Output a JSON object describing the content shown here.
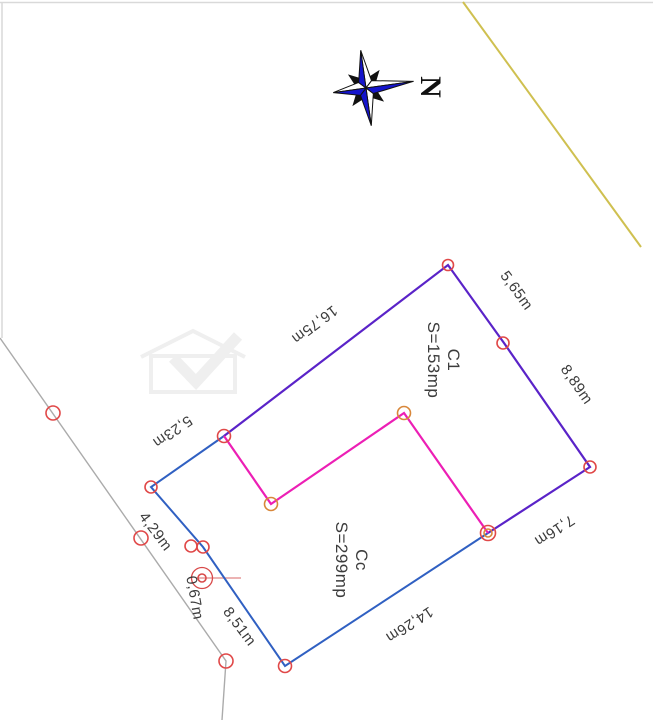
{
  "compass": {
    "north_label": "N"
  },
  "colors": {
    "boundary_blue": "#3060c2",
    "building_purple": "#5a23c8",
    "inner_pink": "#ec1fb5",
    "vertex_red": "#e04848",
    "vertex_orange": "#d8873a",
    "road_gray": "#ababab",
    "utility_yellow": "#cfc050",
    "target_red": "#d84848",
    "leader_pink": "#e59a9a",
    "label_color": "#3c3c3c",
    "compass_blue": "#1414cc",
    "compass_black": "#111111",
    "watermark_gray": "#efefef",
    "frame_gray": "#d9d9d9"
  },
  "dimensions": [
    {
      "id": "edge-ga",
      "text": "16,75m"
    },
    {
      "id": "edge-ab",
      "text": "5,65m"
    },
    {
      "id": "edge-bc",
      "text": "8,89m"
    },
    {
      "id": "edge-cd",
      "text": "7,16m"
    },
    {
      "id": "edge-de",
      "text": "14,26m"
    },
    {
      "id": "edge-ve",
      "text": "8,51m"
    },
    {
      "id": "edge-fv",
      "text": "4,29m"
    },
    {
      "id": "edge-fg",
      "text": "5,23m"
    },
    {
      "id": "target-offset",
      "text": "0,67m"
    }
  ],
  "areas": {
    "building": {
      "name": "C1",
      "area": "S=153mp"
    },
    "courtyard": {
      "name": "Cc",
      "area": "S=299mp"
    }
  }
}
